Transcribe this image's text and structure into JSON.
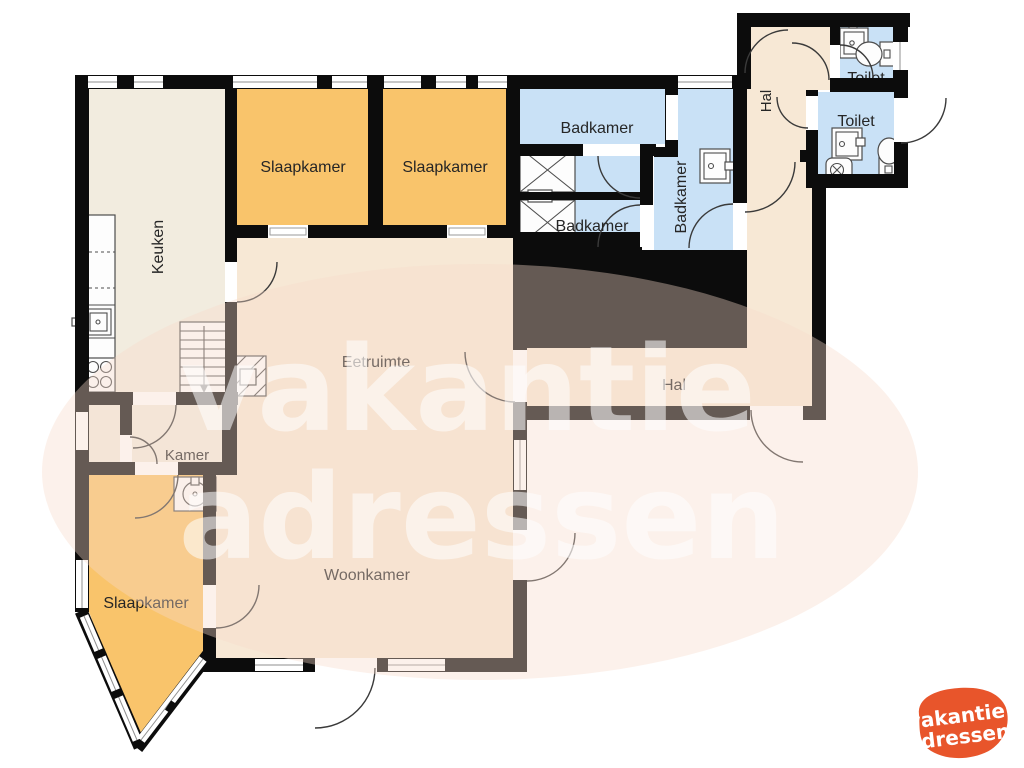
{
  "rooms": {
    "keuken": "Keuken",
    "slaapkamer1": "Slaapkamer",
    "slaapkamer2": "Slaapkamer",
    "slaapkamer3": "Slaapkamer",
    "badkamer_top": "Badkamer",
    "badkamer_left": "Badkamer",
    "badkamer_right": "Badkamer",
    "toilet_top": "Toilet",
    "toilet_right": "Toilet",
    "hal_annex": "Hal",
    "hal_main": "Hal",
    "eetruimte": "Eetruimte",
    "kamer": "Kamer",
    "woonkamer": "Woonkamer"
  },
  "watermark": {
    "line1": "vakantie",
    "line2": "adressen"
  },
  "logo": {
    "line1": "vakantie",
    "line2": "adressen"
  },
  "colors": {
    "wall": "#0c0c0c",
    "beige": "#f2ecdf",
    "beige2": "#f7e8d5",
    "orange": "#f9c46b",
    "blue": "#c9e1f6",
    "logo": "#e8552b"
  }
}
